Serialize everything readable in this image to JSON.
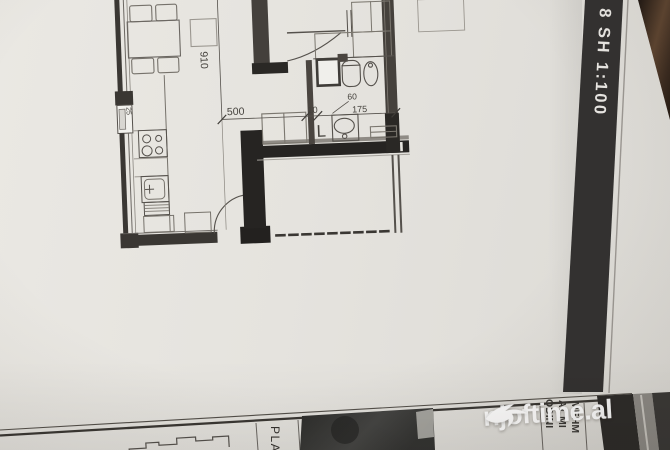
{
  "sheet_strip": {
    "label": "8 SH 1:100"
  },
  "floor_plan": {
    "dimensions": {
      "width": "500",
      "height": "910",
      "gap": "10",
      "bath_width": "175",
      "duct": "60",
      "wall": "25"
    },
    "symbols": {
      "laundry": "L"
    }
  },
  "title_block": {
    "vertical_title": "PLA",
    "info_lines": [
      "ODINI",
      "AT MI",
      "MEHM"
    ]
  },
  "watermark": {
    "text": "njoftime.al"
  },
  "colors": {
    "paper": "#e5e3de",
    "ink": "#3a3733",
    "wall_black": "#262422",
    "strip": "#333130",
    "wood": "#4a3526"
  }
}
